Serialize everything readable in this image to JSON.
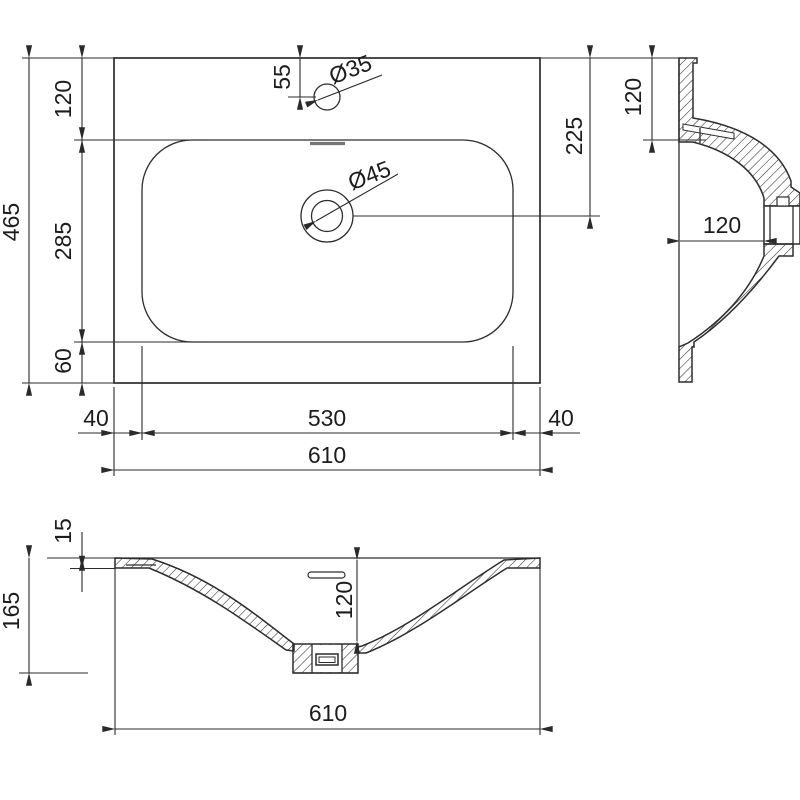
{
  "drawing": {
    "type": "washbasin-technical-drawing",
    "units": "mm",
    "colors": {
      "line": "#2d2d2d",
      "dim_text": "#1c1c1c",
      "background": "#ffffff",
      "overflow_mark": "#777777"
    },
    "top_view": {
      "depth_total": "465",
      "rim_back": "120",
      "basin_depth": "285",
      "rim_front": "60",
      "faucet_offset": "55",
      "drain_offset": "225",
      "faucet_diameter": "Ø35",
      "drain_diameter": "Ø45",
      "margin_left": "40",
      "basin_width": "530",
      "margin_right": "40",
      "total_width": "610"
    },
    "side_view": {
      "rim_width": "120",
      "bowl_depth": "120"
    },
    "front_view": {
      "slab_thickness": "15",
      "total_height": "165",
      "bowl_depth": "120",
      "total_width": "610"
    }
  }
}
